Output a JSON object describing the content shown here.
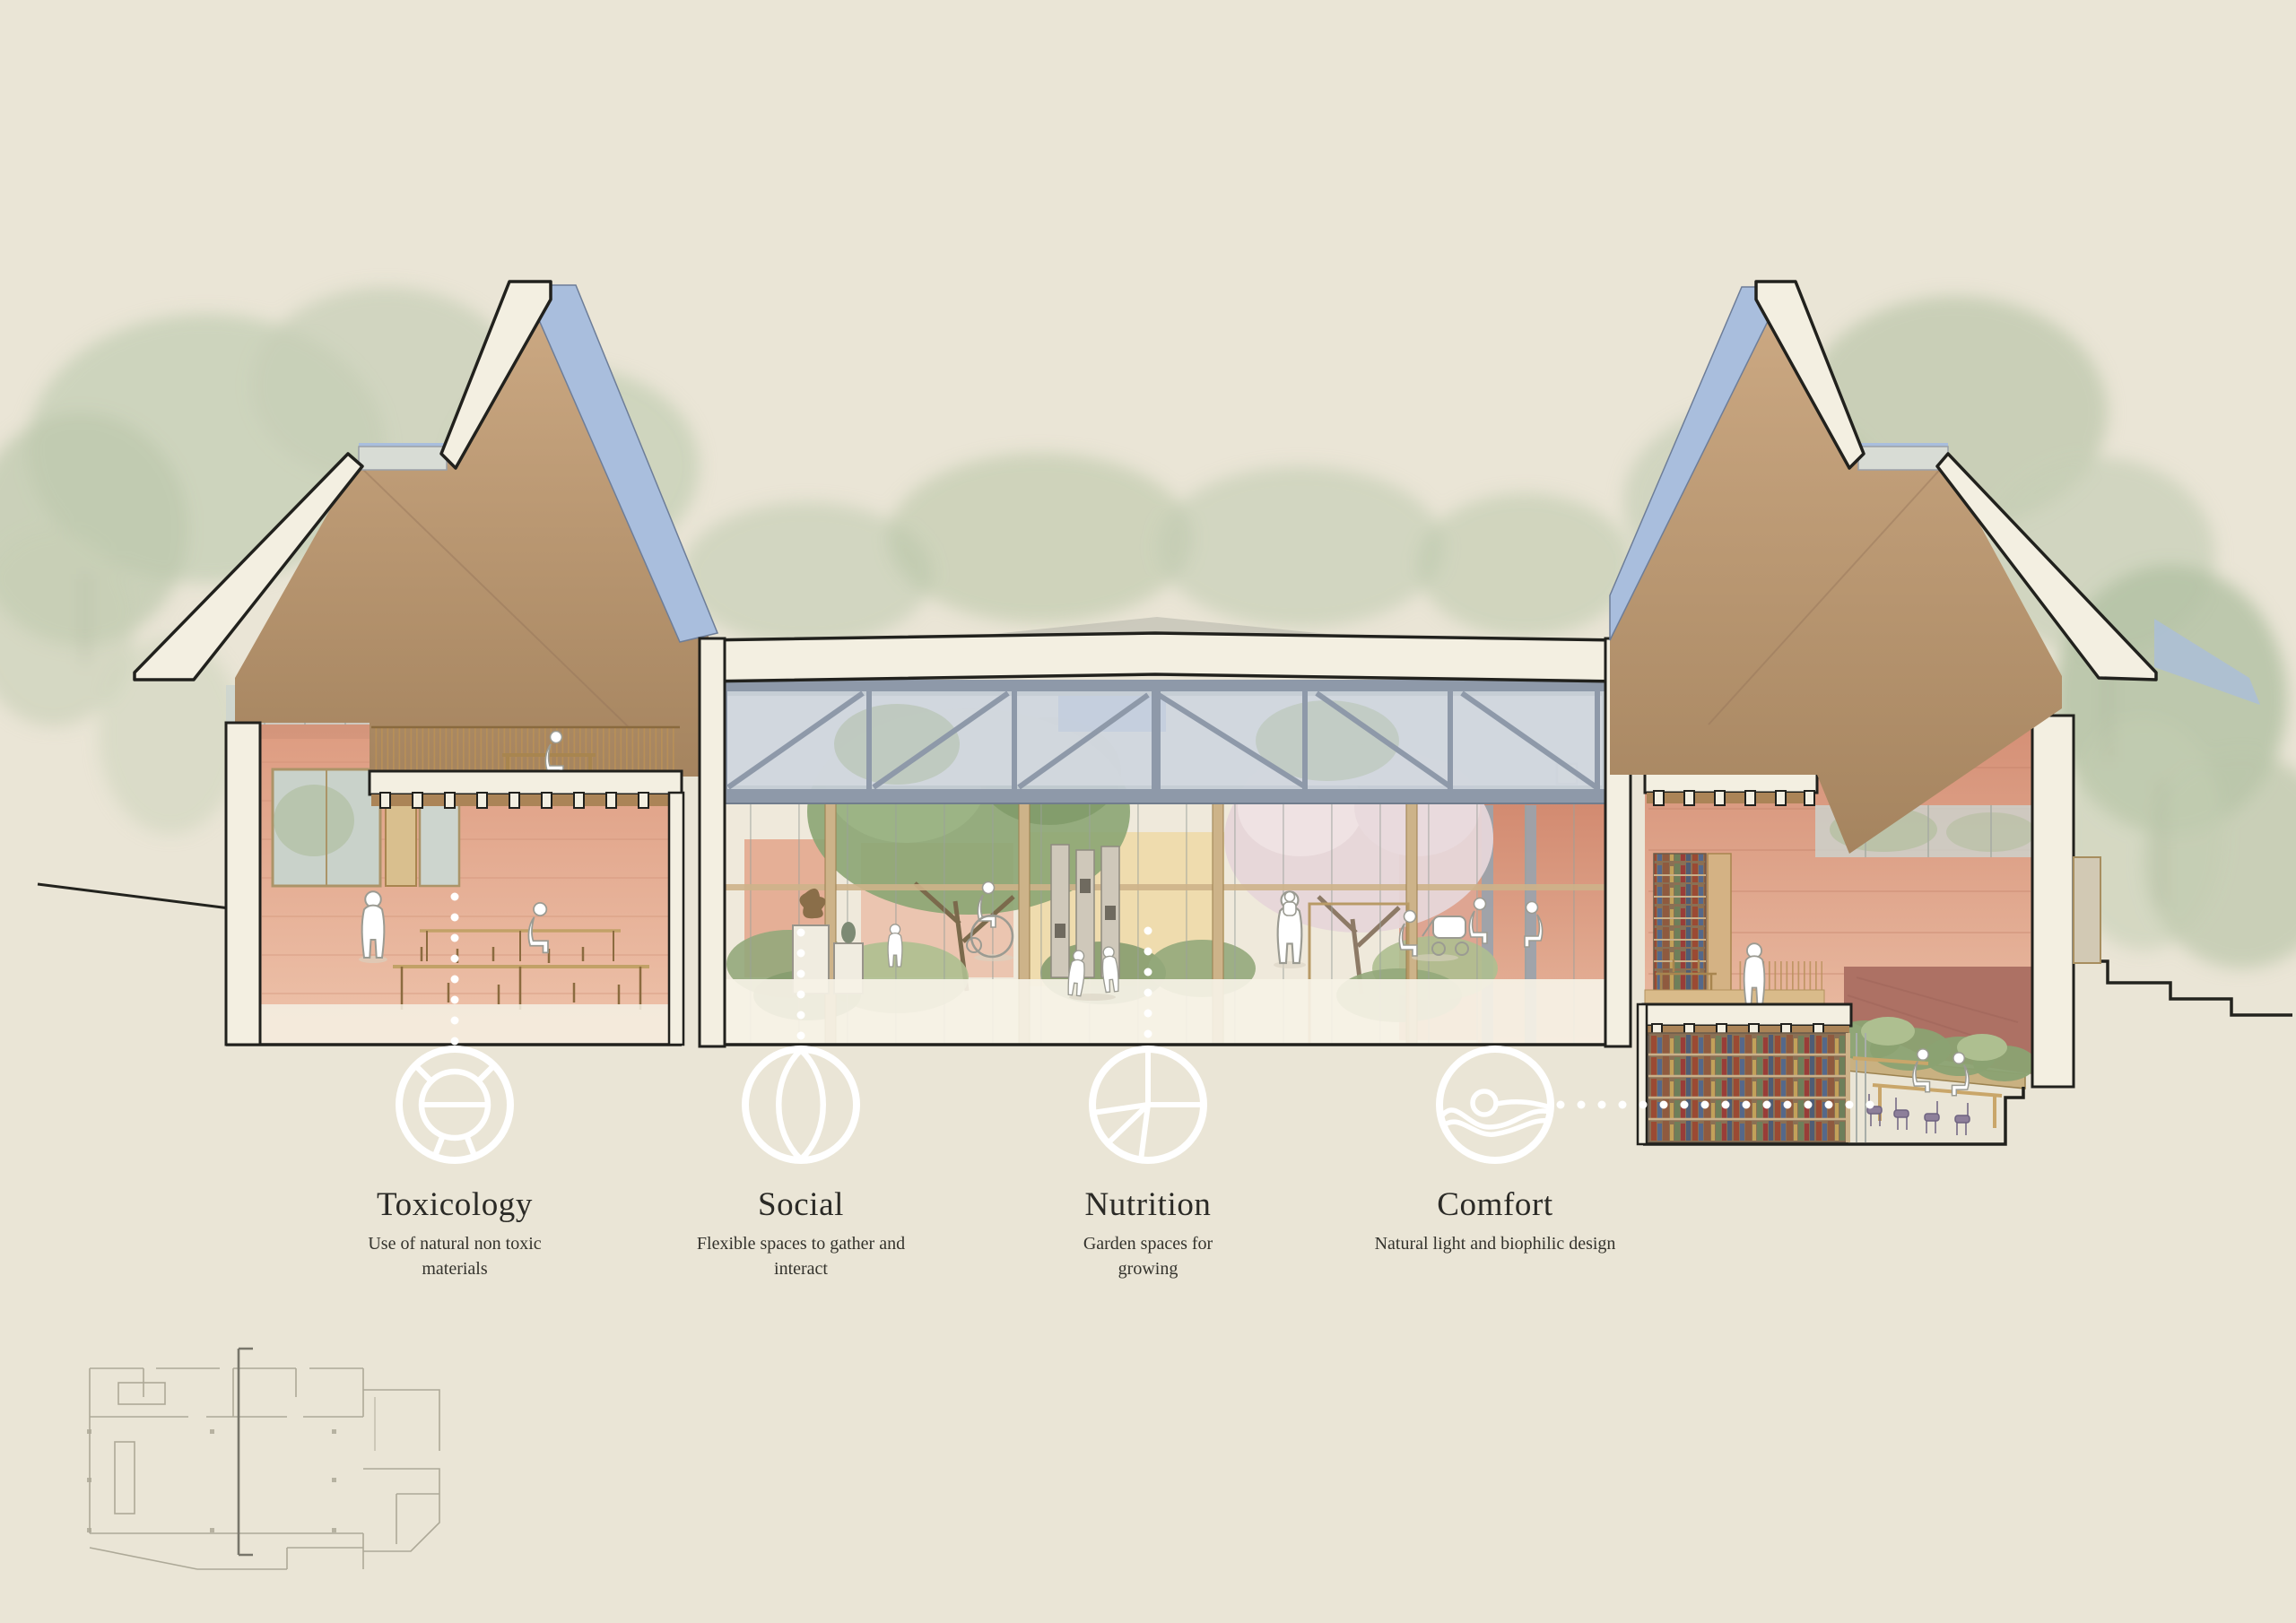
{
  "pillars": [
    {
      "title": "Toxicology",
      "description": "Use of natural non toxic materials",
      "icon": "ring-segments-icon"
    },
    {
      "title": "Social",
      "description": "Flexible spaces to gather and interact",
      "icon": "circle-lens-icon"
    },
    {
      "title": "Nutrition",
      "description": "Garden spaces for growing",
      "icon": "segmented-plate-icon"
    },
    {
      "title": "Comfort",
      "description": "Natural light and biophilic design",
      "icon": "wave-rest-icon"
    }
  ],
  "colors": {
    "board_background": "#eae5d6",
    "section_poche": "#f3efe1",
    "section_outline": "#21211d",
    "rammed_earth_wall": "#e2a287",
    "roof_soffit_timber": "#bb9a77",
    "roof_glazing_blue": "#a9bedd",
    "steel_truss": "#8e99a9",
    "timber_mullion": "#cdb389",
    "foliage": "#a9bb8a",
    "callout_white": "#ffffff",
    "label_text": "#2b2a26"
  }
}
